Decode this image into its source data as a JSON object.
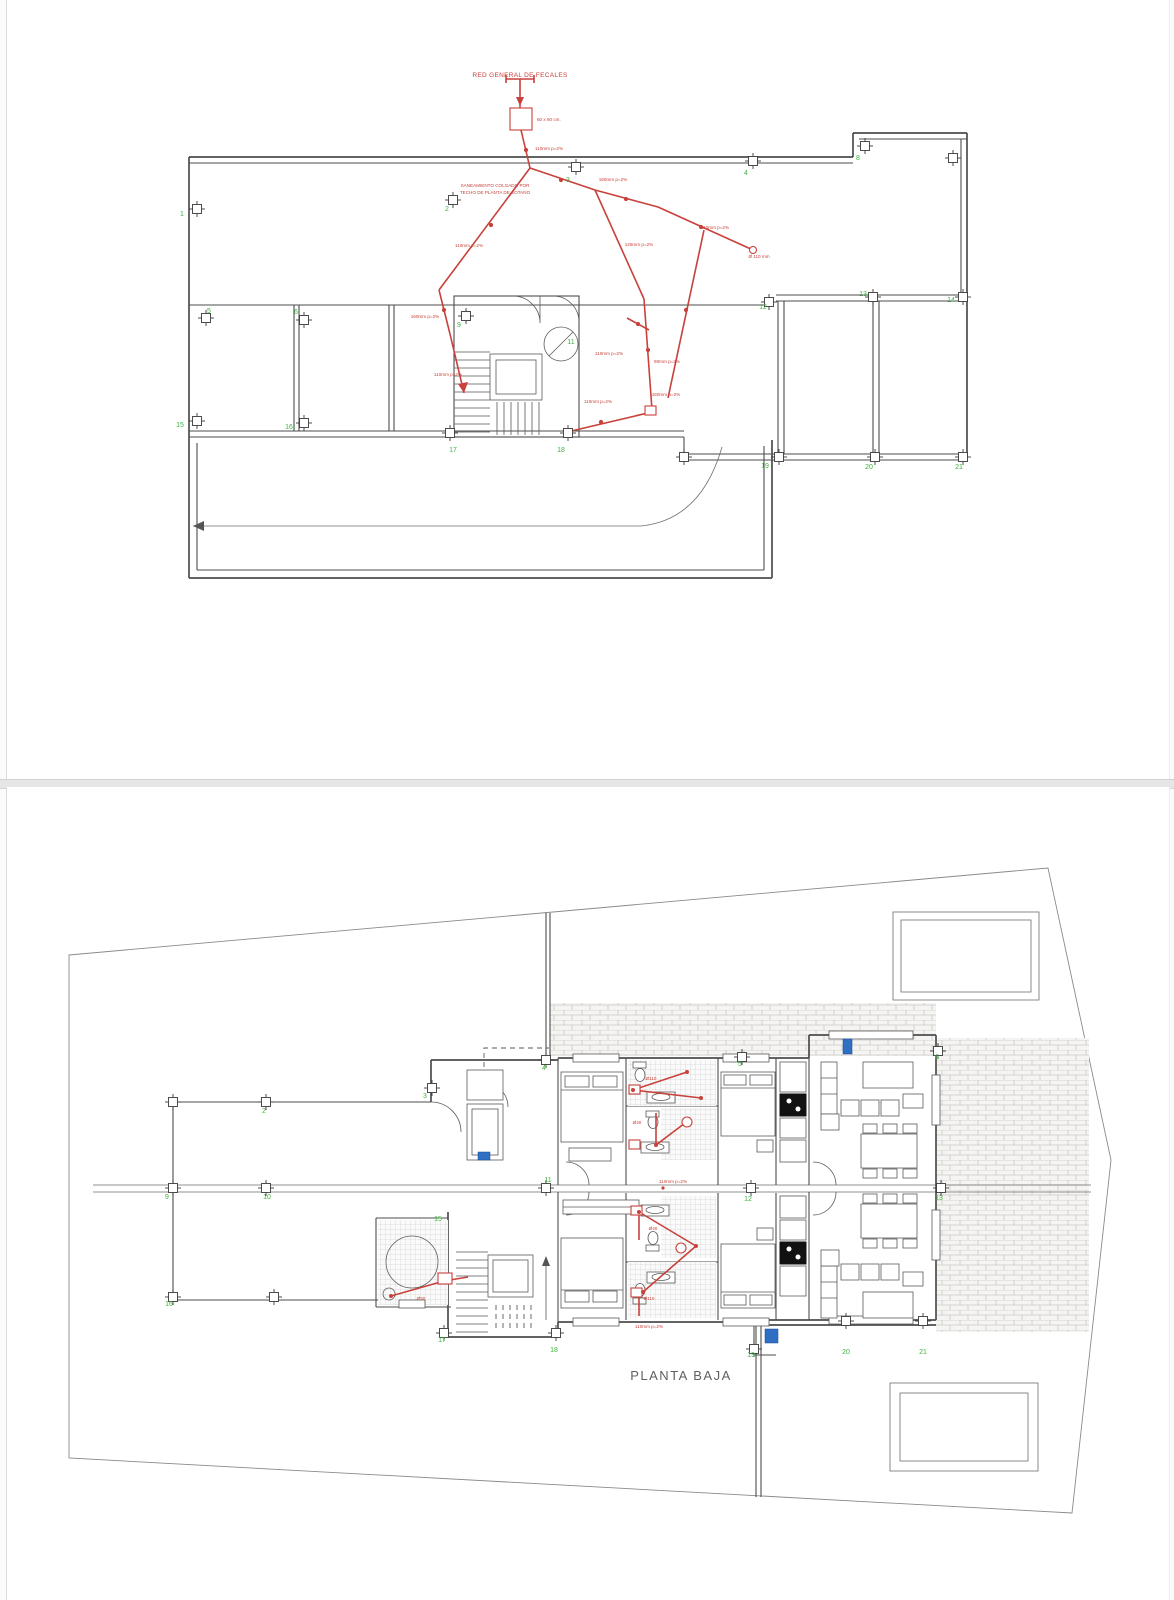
{
  "top_plan": {
    "title": "RED GENERAL DE FECALES",
    "arqueta_label": "60 x 60 cm.",
    "note_line1": "SANEAMIENTO COLGADO POR",
    "note_line2": "TECHO DE PLANTA DE SOTANO",
    "pipe_labels": [
      {
        "t": "110mm p=2%",
        "x": 548,
        "y": 150
      },
      {
        "t": "160mm p=2%",
        "x": 612,
        "y": 181
      },
      {
        "t": "125mm p=2%",
        "x": 638,
        "y": 246
      },
      {
        "t": "110mm p=2%",
        "x": 714,
        "y": 229
      },
      {
        "t": "Ø 110 mm",
        "x": 758,
        "y": 258
      },
      {
        "t": "110mm p=2%",
        "x": 468,
        "y": 247
      },
      {
        "t": "160mm p=2%",
        "x": 424,
        "y": 318
      },
      {
        "t": "110mm p=2%",
        "x": 447,
        "y": 376
      },
      {
        "t": "110mm p=2%",
        "x": 608,
        "y": 355
      },
      {
        "t": "90mm p=2%",
        "x": 666,
        "y": 363
      },
      {
        "t": "110mm p=2%",
        "x": 597,
        "y": 403
      },
      {
        "t": "160mm p=2%",
        "x": 665,
        "y": 396
      }
    ],
    "grid_numbers": [
      {
        "n": "1",
        "x": 181,
        "y": 216
      },
      {
        "n": "2",
        "x": 446,
        "y": 211
      },
      {
        "n": "3",
        "x": 567,
        "y": 182
      },
      {
        "n": "4",
        "x": 745,
        "y": 175
      },
      {
        "n": "8",
        "x": 857,
        "y": 160
      },
      {
        "n": "5",
        "x": 208,
        "y": 313
      },
      {
        "n": "6",
        "x": 295,
        "y": 314
      },
      {
        "n": "9",
        "x": 458,
        "y": 327
      },
      {
        "n": "11",
        "x": 570,
        "y": 344
      },
      {
        "n": "12",
        "x": 762,
        "y": 309
      },
      {
        "n": "13",
        "x": 862,
        "y": 296
      },
      {
        "n": "14",
        "x": 950,
        "y": 302
      },
      {
        "n": "15",
        "x": 179,
        "y": 427
      },
      {
        "n": "16",
        "x": 288,
        "y": 429
      },
      {
        "n": "17",
        "x": 452,
        "y": 452
      },
      {
        "n": "18",
        "x": 560,
        "y": 452
      },
      {
        "n": "19",
        "x": 764,
        "y": 468
      },
      {
        "n": "20",
        "x": 868,
        "y": 469
      },
      {
        "n": "21",
        "x": 958,
        "y": 469
      }
    ]
  },
  "bottom_plan": {
    "title": "PLANTA BAJA",
    "pipe_labels": [
      {
        "t": "110mm p=2%",
        "x": 672,
        "y": 1183
      },
      {
        "t": "Ø110",
        "x": 650,
        "y": 1080
      },
      {
        "t": "Ø40",
        "x": 636,
        "y": 1124
      },
      {
        "t": "Ø40",
        "x": 652,
        "y": 1230
      },
      {
        "t": "Ø110",
        "x": 648,
        "y": 1300
      },
      {
        "t": "Ø50",
        "x": 420,
        "y": 1300
      },
      {
        "t": "110mm p=2%",
        "x": 648,
        "y": 1328
      }
    ],
    "grid_numbers": [
      {
        "n": "2",
        "x": 263,
        "y": 1113
      },
      {
        "n": "3",
        "x": 424,
        "y": 1098
      },
      {
        "n": "4",
        "x": 543,
        "y": 1070
      },
      {
        "n": "5",
        "x": 739,
        "y": 1066
      },
      {
        "n": "6",
        "x": 936,
        "y": 1059
      },
      {
        "n": "9",
        "x": 166,
        "y": 1199
      },
      {
        "n": "10",
        "x": 266,
        "y": 1199
      },
      {
        "n": "11",
        "x": 547,
        "y": 1182
      },
      {
        "n": "12",
        "x": 747,
        "y": 1201
      },
      {
        "n": "13",
        "x": 938,
        "y": 1200
      },
      {
        "n": "15",
        "x": 437,
        "y": 1221
      },
      {
        "n": "16",
        "x": 168,
        "y": 1306
      },
      {
        "n": "17",
        "x": 441,
        "y": 1342
      },
      {
        "n": "18",
        "x": 553,
        "y": 1352
      },
      {
        "n": "19",
        "x": 750,
        "y": 1357
      },
      {
        "n": "20",
        "x": 845,
        "y": 1354
      },
      {
        "n": "21",
        "x": 922,
        "y": 1354
      }
    ]
  },
  "colors": {
    "pipe": "#c8413b",
    "grid": "#3db43d",
    "wall": "#4d4d4d",
    "site": "#8a8a8a",
    "marker_blue": "#2f6fc4"
  }
}
